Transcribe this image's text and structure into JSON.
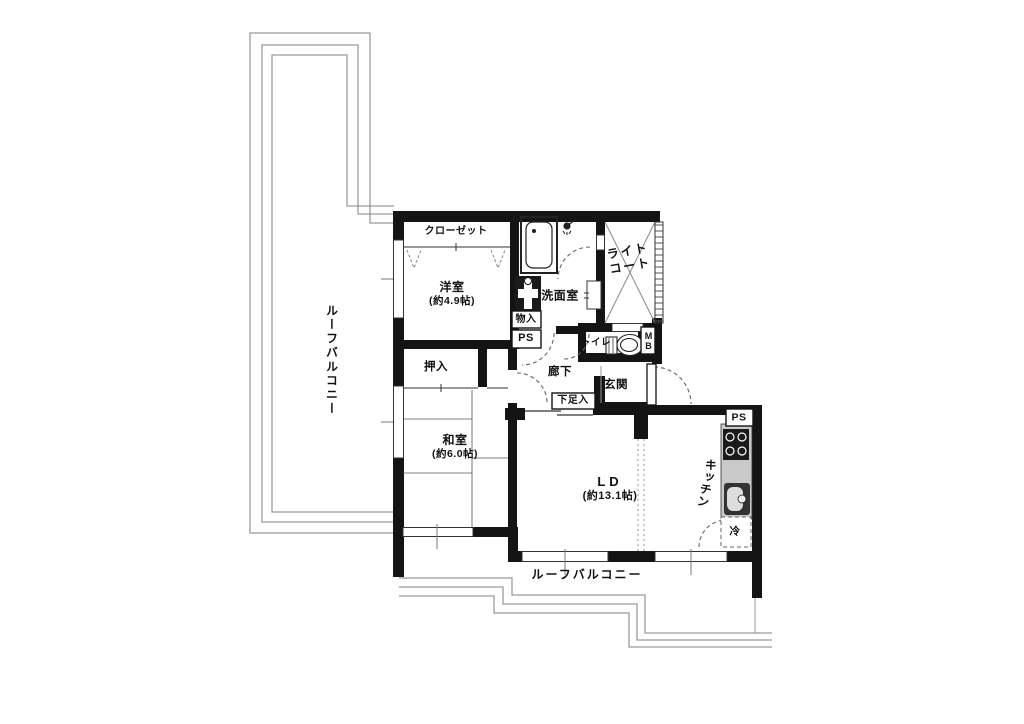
{
  "floorplan": {
    "labels": {
      "roof_balcony_left": "ルーフバルコニー",
      "roof_balcony_bottom": "ルーフバルコニー",
      "closet": "クローゼット",
      "western_room_name": "洋室",
      "western_room_size": "(約4.9帖)",
      "washroom": "洗面室",
      "light_court_line1": "ライト",
      "light_court_line2": "コート",
      "storage_small": "物入",
      "pipe_space_1": "PS",
      "toilet": "トイレ",
      "meter_box": "MB",
      "corridor": "廊下",
      "entrance": "玄関",
      "shoe_cabinet": "下足入",
      "oshiire": "押入",
      "japanese_room_name": "和室",
      "japanese_room_size": "(約6.0帖)",
      "living_dining_name": "LD",
      "living_dining_size": "(約13.1帖)",
      "kitchen": "キッチン",
      "pipe_space_2": "PS",
      "refrigerator": "冷"
    },
    "colors": {
      "wall": "#141414",
      "railing": "#9a9a9a",
      "counter": "#c9c9c9",
      "background": "#ffffff"
    }
  }
}
